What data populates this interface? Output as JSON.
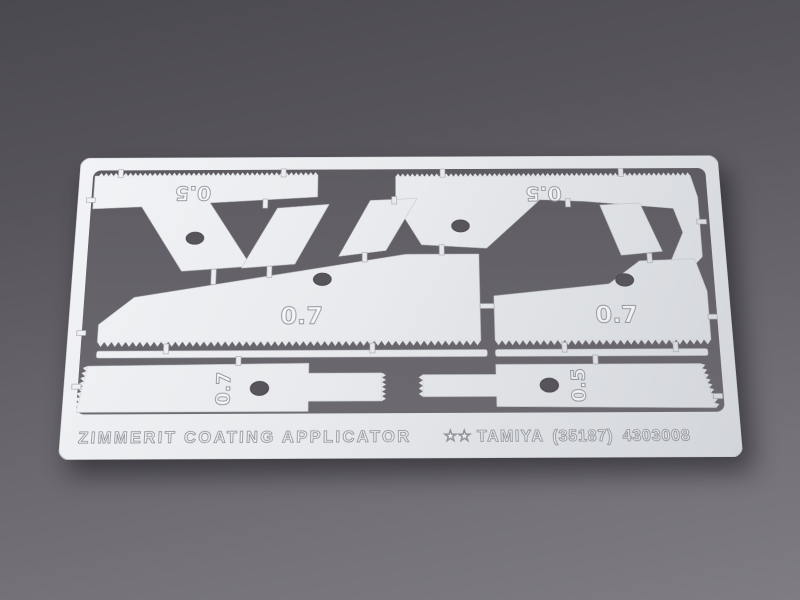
{
  "scene": {
    "background_top_color": "#4b4950",
    "background_bottom_color": "#7f7c83",
    "sheet_color": "#e8eaed",
    "etch_cutout_color": "#67646c"
  },
  "sheet": {
    "markings": {
      "top_left_blade": "0.5",
      "top_right_blade": "0.5",
      "mid_left_blade": "0.7",
      "mid_right_blade": "0.7",
      "bottom_left_tool": "0.7",
      "bottom_right_tool": "0.5"
    },
    "footer": {
      "product_name": "ZIMMERIT COATING APPLICATOR",
      "logo": "★★",
      "brand": "TAMIYA",
      "item_number": "(35187)",
      "part_number": "4303008"
    }
  }
}
